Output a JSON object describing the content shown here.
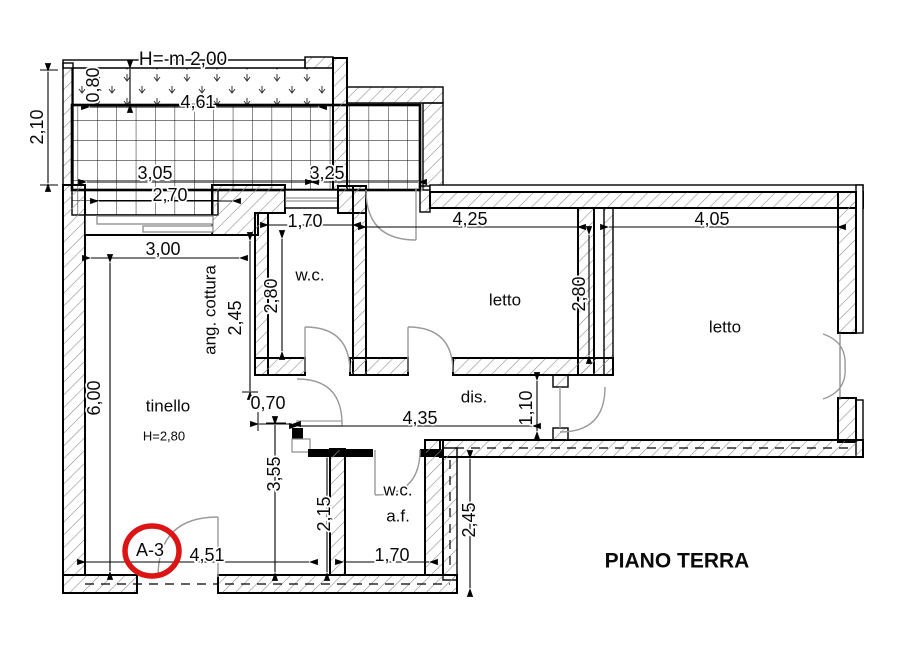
{
  "plan": {
    "title": "PIANO TERRA",
    "sheet_ref": "A-3",
    "terrace_height_note": "H= m 2,00",
    "tinello_height_note": "H=2,80"
  },
  "rooms": {
    "wc": "w.c.",
    "letto1": "letto",
    "letto2": "letto",
    "tinello": "tinello",
    "ang_cottura": "ang. cottura",
    "dis": "dis.",
    "wcaf_line1": "w.c.",
    "wcaf_line2": "a.f."
  },
  "dims": {
    "terrace_side": "2,10",
    "parapet_h": "0,80",
    "terrace_top": "4,61",
    "span_left": "3,05",
    "span_right": "3,25",
    "slider_w": "2,70",
    "cottura_w": "3,00",
    "cottura_h": "2,45",
    "wc_w": "1,70",
    "wc_h": "2,80",
    "letto1_w": "4,25",
    "letto1_h": "2,80",
    "letto2_w": "4,05",
    "tinello_h": "6,00",
    "stub_w": "0,70",
    "dis_l": "4,35",
    "dis_w": "1,10",
    "tinello_low_h": "3,55",
    "wcaf_h": "2,15",
    "east_wall_h": "2,45",
    "wcaf_w": "1,70",
    "tinello_w": "4,51"
  },
  "colors": {
    "accent_red": "#dd1414",
    "wall": "#000000",
    "hatch": "#909090",
    "door": "#9a9a9a"
  }
}
